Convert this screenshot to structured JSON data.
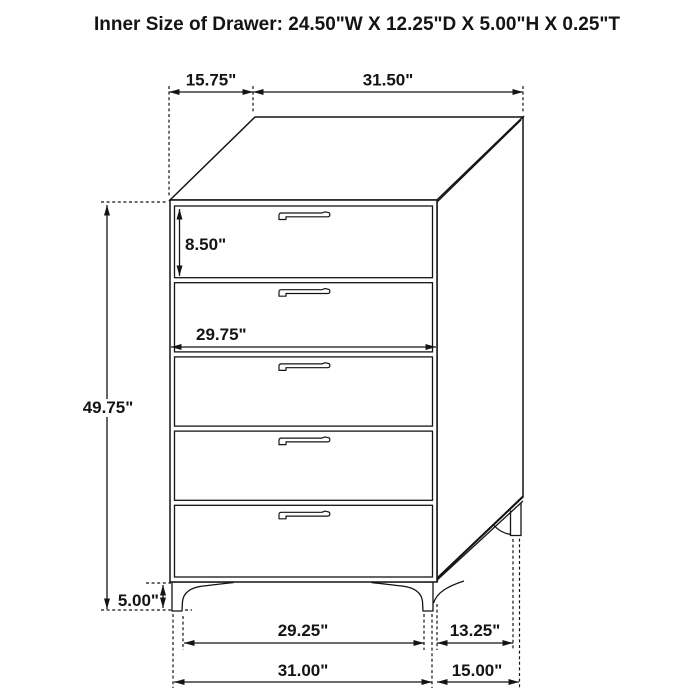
{
  "title": "Inner Size of Drawer: 24.50\"W X 12.25\"D X 5.00\"H X 0.25\"T",
  "dimensions": {
    "top_depth": "15.75\"",
    "top_width": "31.50\"",
    "drawer_front_height": "8.50\"",
    "drawer_inner_width": "29.75\"",
    "overall_height": "49.75\"",
    "leg_height": "5.00\"",
    "front_feet_inner_span": "29.25\"",
    "side_feet_gap": "13.25\"",
    "overall_width": "31.00\"",
    "overall_depth": "15.00\""
  },
  "figure": {
    "drawer_count": 5,
    "line_color": "#141414",
    "background_color": "#ffffff"
  }
}
